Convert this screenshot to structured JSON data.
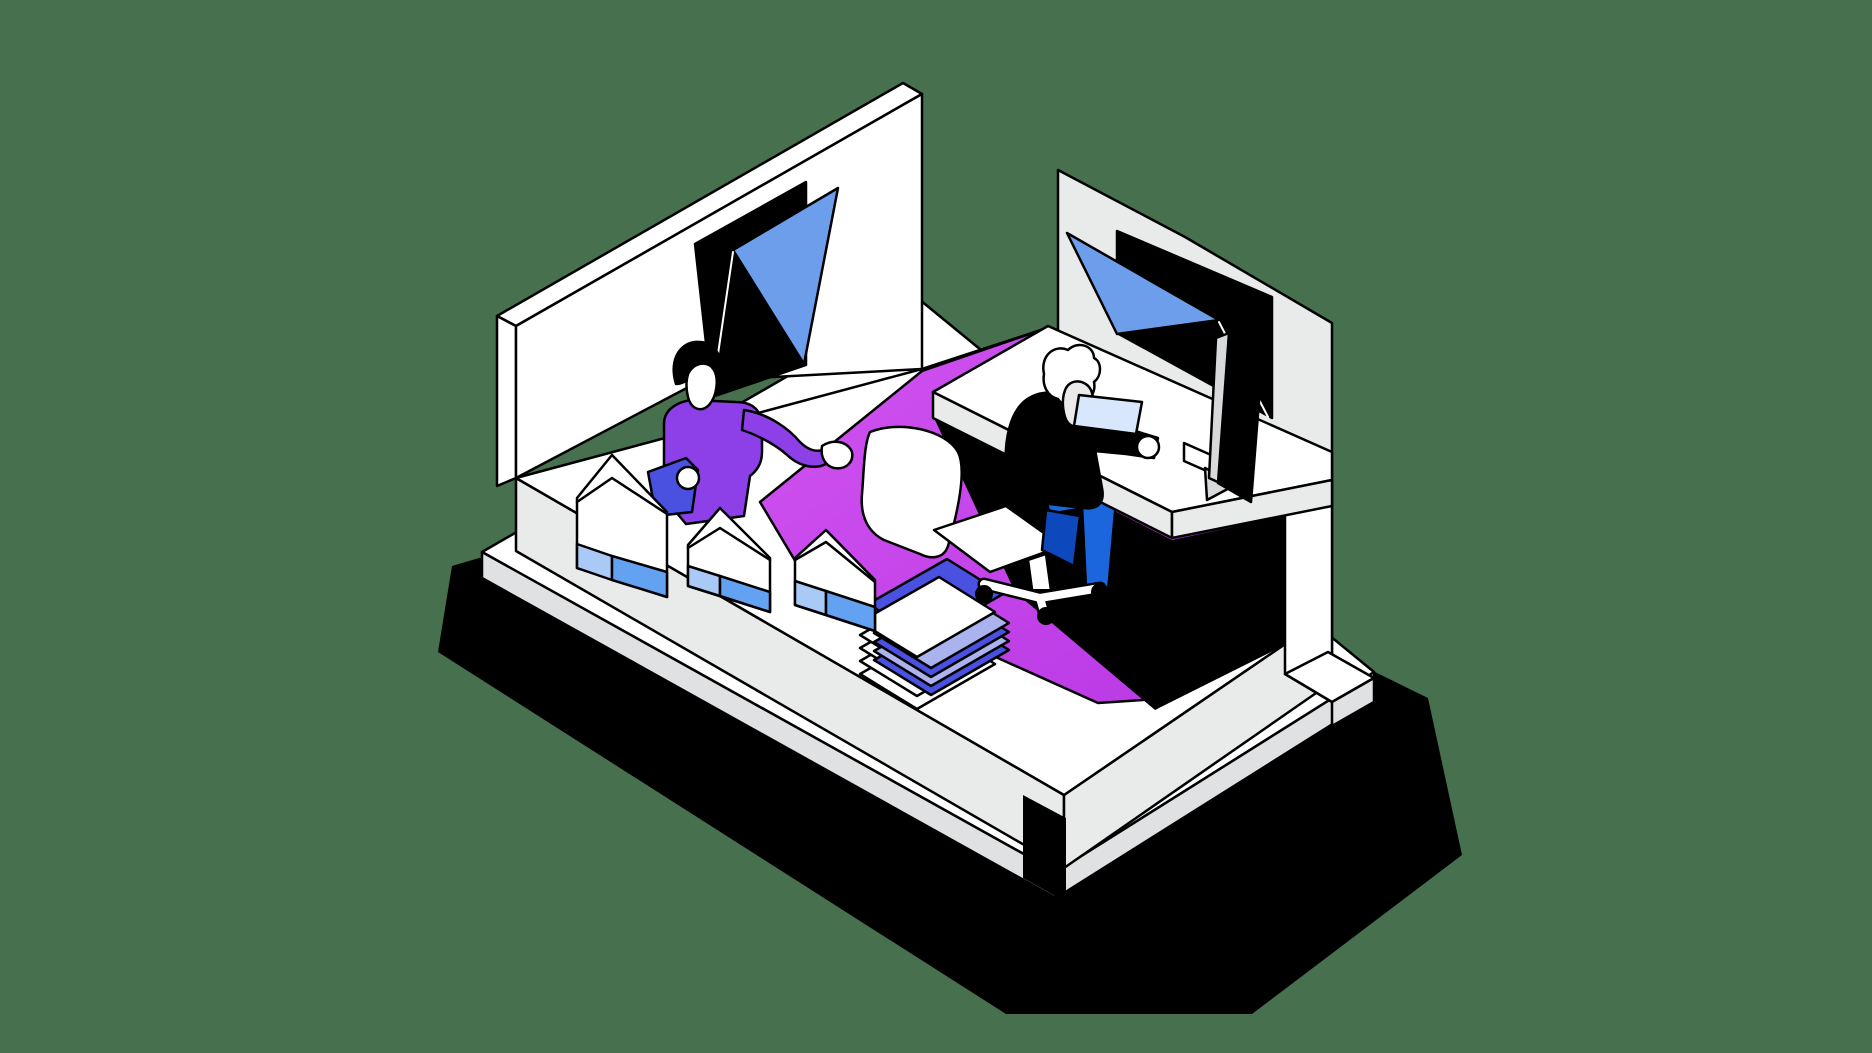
{
  "scene": {
    "kind": "isometric-office-illustration",
    "objects": [
      "platform",
      "floor-shadow",
      "area-rug",
      "left-wall",
      "left-wall-window",
      "right-partition",
      "partition-window",
      "right-wall-pillar",
      "desk",
      "monitor",
      "desktop-box",
      "office-chair",
      "seated-worker",
      "document-in-hand",
      "standing-worker",
      "held-pouch",
      "shopping-bag",
      "paper-stack"
    ]
  },
  "palette": {
    "background": "#47704E",
    "shadow": "#000000",
    "ink": "#000000",
    "white": "#FFFFFF",
    "grey_light": "#E9EAEA",
    "grey_mid": "#DFE1E2",
    "rug_light": "#D254F0",
    "rug_dark": "#B736E4",
    "window_blue": "#6D9EEC",
    "bag_blue": "#63A1F1",
    "bag_blue_light": "#A9C9F6",
    "accent_violet": "#4A51E1",
    "accent_lavender": "#AAB3EE",
    "sweater_purple": "#8D3FE8",
    "pouch_blue": "#4A51E1",
    "pants_blue": "#1B66DD",
    "pants_blue_dark": "#0D49BC",
    "paper_blue": "#D9E7FC",
    "monitor_grey": "#D7D9DA",
    "skin_light": "#EAEAEA"
  }
}
